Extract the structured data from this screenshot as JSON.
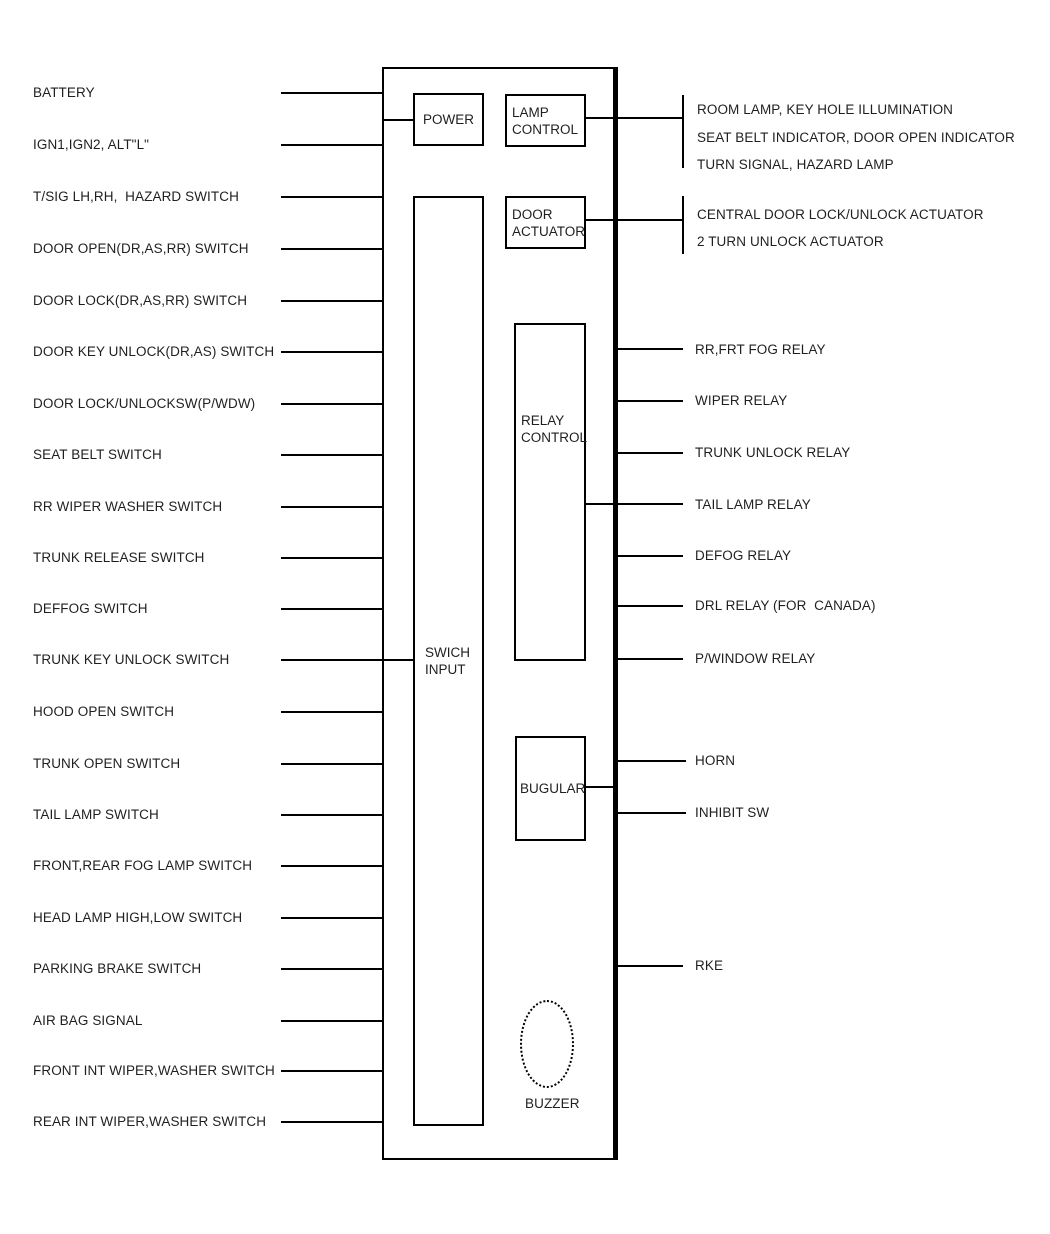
{
  "colors": {
    "line": "#000000",
    "text": "#1f1f1f",
    "background": "#ffffff"
  },
  "left_inputs": [
    "BATTERY",
    "IGN1,IGN2, ALT\"L\"",
    "T/SIG LH,RH,  HAZARD SWITCH",
    "DOOR OPEN(DR,AS,RR) SWITCH",
    "DOOR LOCK(DR,AS,RR) SWITCH",
    "DOOR KEY UNLOCK(DR,AS) SWITCH",
    "DOOR LOCK/UNLOCKSW(P/WDW)",
    "SEAT BELT SWITCH",
    "RR WIPER WASHER SWITCH",
    "TRUNK RELEASE SWITCH",
    "DEFFOG SWITCH",
    "TRUNK KEY UNLOCK SWITCH",
    "HOOD OPEN SWITCH",
    "TRUNK OPEN SWITCH",
    "TAIL LAMP SWITCH",
    "FRONT,REAR FOG LAMP SWITCH",
    "HEAD LAMP HIGH,LOW SWITCH",
    "PARKING BRAKE SWITCH",
    "AIR BAG SIGNAL",
    "FRONT INT WIPER,WASHER SWITCH",
    "REAR INT WIPER,WASHER SWITCH"
  ],
  "boxes": {
    "power": "POWER",
    "lamp_control": "LAMP\nCONTROL",
    "door_actuator": "DOOR\nACTUATOR",
    "relay_control": "RELAY\nCONTROL",
    "swich_input": "SWICH\nINPUT",
    "bugular": "BUGULAR",
    "buzzer": "BUZZER"
  },
  "outputs": {
    "lamp_group": [
      "ROOM LAMP, KEY HOLE ILLUMINATION",
      "SEAT BELT INDICATOR, DOOR OPEN INDICATOR",
      "TURN SIGNAL, HAZARD LAMP"
    ],
    "door_group": [
      "CENTRAL DOOR LOCK/UNLOCK ACTUATOR",
      "2 TURN UNLOCK ACTUATOR"
    ],
    "relays": [
      "RR,FRT FOG RELAY",
      "WIPER RELAY",
      "TRUNK UNLOCK RELAY",
      "TAIL LAMP RELAY",
      "DEFOG RELAY",
      "DRL RELAY (FOR  CANADA)",
      "P/WINDOW RELAY"
    ],
    "horn": "HORN",
    "inhibit": "INHIBIT SW",
    "rke": "RKE"
  }
}
